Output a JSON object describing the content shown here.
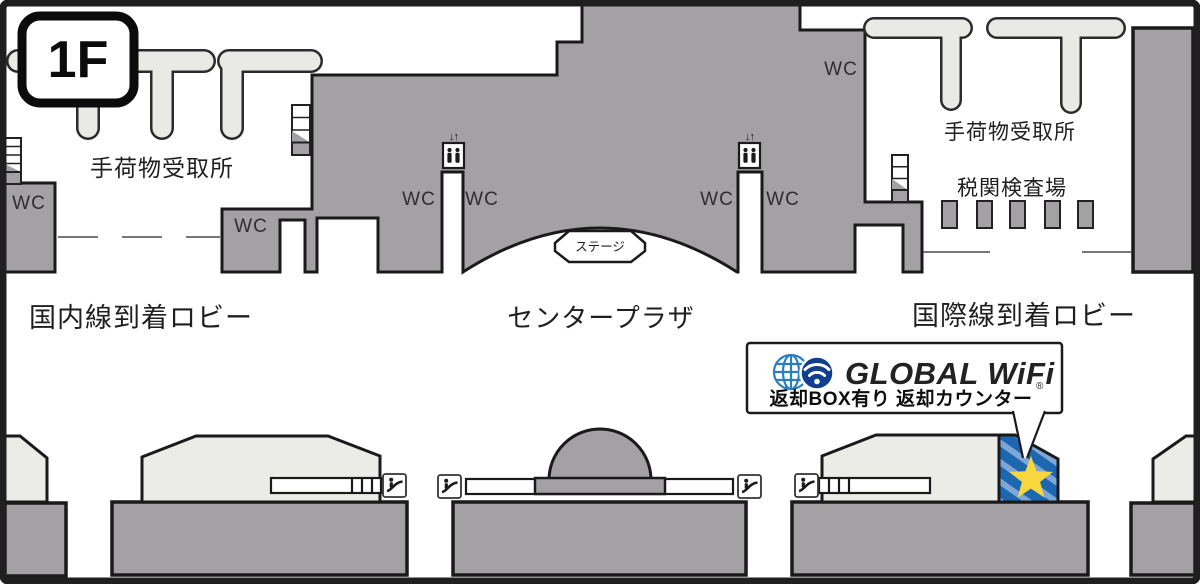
{
  "floor_badge": {
    "label": "1F"
  },
  "areas": {
    "baggage_claim_left": "手荷物受取所",
    "baggage_claim_right": "手荷物受取所",
    "customs_inspection": "税関検査場",
    "domestic_arrival_lobby": "国内線到着ロビー",
    "center_plaza": "センタープラザ",
    "international_arrival_lobby": "国際線到着ロビー",
    "stage": "ステージ",
    "toilet": "WC"
  },
  "elevator": {
    "arrows": "↓↑"
  },
  "callout": {
    "brand": "GLOBAL WiFi",
    "registered_mark": "®",
    "note": "返却BOX有り 返却カウンター"
  },
  "colors": {
    "floor_gray": "#a3a1a4",
    "counter_light": "#ebebe8",
    "carousel_light": "#e9e9e6",
    "highlight_blue": "#1d66b0",
    "stripe_blue": "#7ea6d6",
    "star_yellow": "#f8d73e",
    "brand_navy": "#113e8e",
    "outline_black": "#1f1f1f"
  }
}
